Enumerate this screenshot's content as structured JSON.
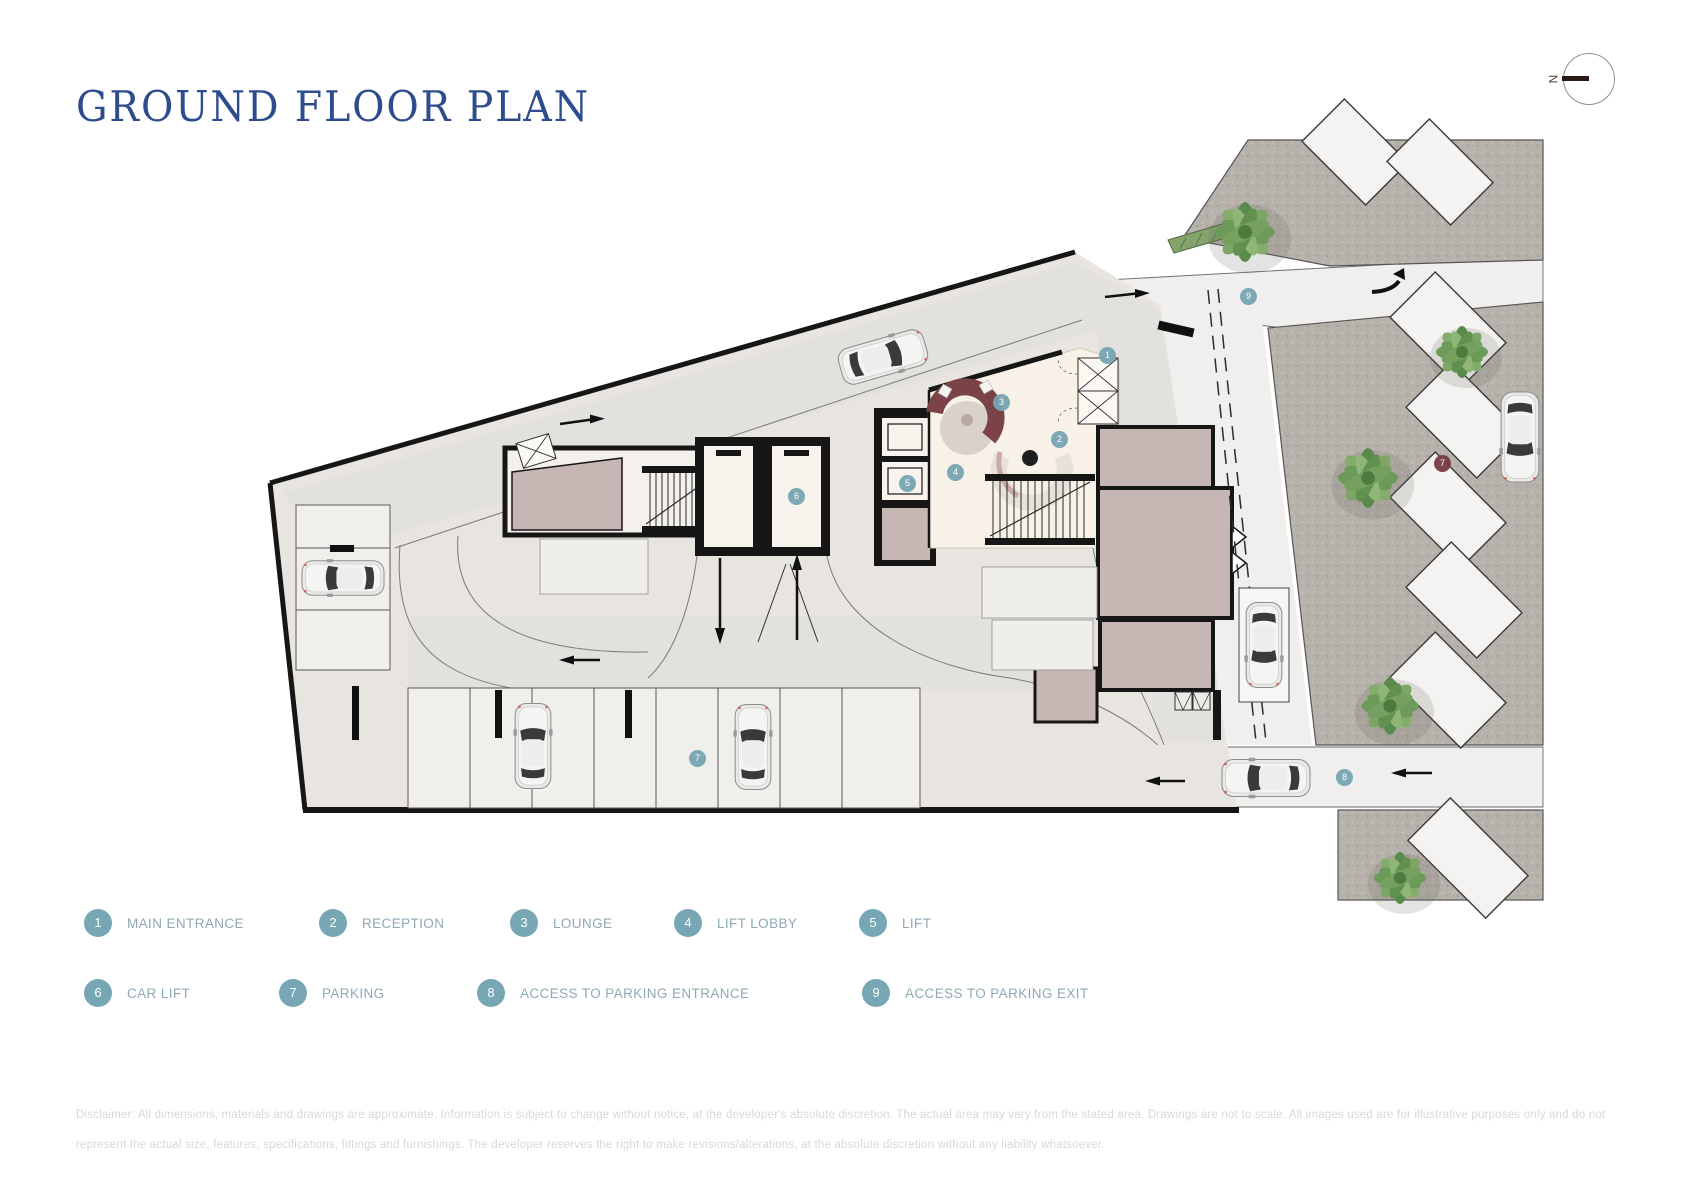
{
  "header": {
    "title": "GROUND FLOOR PLAN"
  },
  "compass": {
    "label": "N"
  },
  "colors": {
    "title_navy": "#2D4C8E",
    "accent_teal": "#77A6B4",
    "legend_label_blue_gray": "#8FA9B4",
    "marker_maroon": "#7A3B44",
    "plot_fill": "#e8e5e1",
    "cobble_gray": "#b6b1aa",
    "room_mauve": "#c6b7b4",
    "room_cream": "#f7f1e8"
  },
  "plan": {
    "markers": [
      {
        "num": "1"
      },
      {
        "num": "2"
      },
      {
        "num": "3"
      },
      {
        "num": "4"
      },
      {
        "num": "5"
      },
      {
        "num": "6"
      },
      {
        "num": "7"
      },
      {
        "num": "8"
      },
      {
        "num": "9"
      },
      {
        "num": "7",
        "variant": "maroon"
      }
    ]
  },
  "legend": {
    "items": [
      {
        "num": "1",
        "label": "MAIN ENTRANCE"
      },
      {
        "num": "2",
        "label": "RECEPTION"
      },
      {
        "num": "3",
        "label": "LOUNGE"
      },
      {
        "num": "4",
        "label": "LIFT LOBBY"
      },
      {
        "num": "5",
        "label": "LIFT"
      },
      {
        "num": "6",
        "label": "CAR LIFT"
      },
      {
        "num": "7",
        "label": "PARKING"
      },
      {
        "num": "8",
        "label": "ACCESS TO PARKING ENTRANCE"
      },
      {
        "num": "9",
        "label": "ACCESS TO PARKING EXIT"
      }
    ]
  },
  "disclaimer": {
    "line1": "Disclaimer: All dimensions, materials and drawings are approximate. Information is subject to change without notice, at the developer's absolute discretion. The actual area may vary from the stated area. Drawings are not to scale. All images used are for illustrative purposes only and do not",
    "line2": "represent the actual size, features, specifications, fittings and furnishings. The developer reserves the right to make revisions/alterations, at the absolute discretion without any liability whatsoever."
  }
}
